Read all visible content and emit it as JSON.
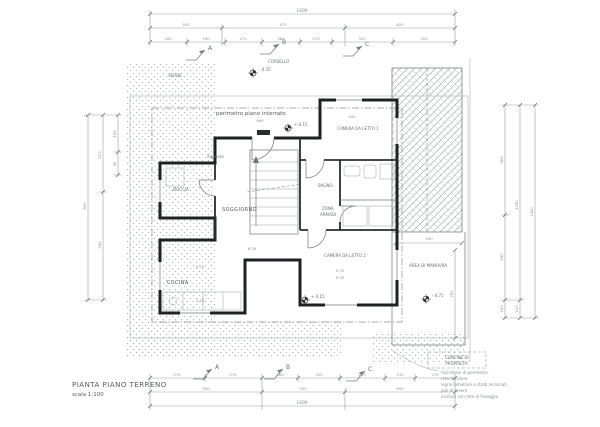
{
  "title_block": {
    "title": "PIANTA PIANO TERRENO",
    "scale": "scala 1:100"
  },
  "labels": {
    "perimeter": "perimetro piano interrato",
    "verde": "VERDE",
    "corsello": "CORSELLO",
    "ingresso": "ingresso",
    "soggiorno": "SOGGIORNO",
    "doccia": "DOCCIA",
    "cucina": "CUCINA",
    "camera1": "CAMERA DA LETTO 1",
    "bagno": "BAGNO",
    "armadi_1": "ZONA",
    "armadi_2": "ARMADI",
    "camera2": "CAMERA DA LETTO 2",
    "area_manovra": "AREA DI MANOVRA",
    "confine_1": "CONFINE DI",
    "confine_2": "PROPRIETA'"
  },
  "sections": {
    "a": "A",
    "b": "B",
    "c": "C"
  },
  "elevations": {
    "corsello": "- 0.35",
    "ingresso": "+ 0.15",
    "camera2": "+ 0.15",
    "manovra": "- 0.75"
  },
  "note": {
    "line1": "recinzione di perimetro:",
    "line2": "rete di colore",
    "line3": "legno lamellare a strati incrociati",
    "line4": "pali di rovere",
    "line5": "incrocci con rete di fissaggio"
  },
  "dims": {
    "top_total": "1600",
    "top_mid": [
      "500",
      "475",
      "620"
    ],
    "top_fine": [
      "185",
      "190",
      "170",
      "380",
      "170",
      "310",
      "310"
    ],
    "bottom_fine": [
      "275",
      "275",
      "180",
      "205",
      "235",
      "140",
      "275"
    ],
    "bottom_mid": [
      "550",
      "400",
      "650"
    ],
    "bottom_total": "1600",
    "left_outer": "800",
    "left_mid": [
      "370",
      "595"
    ],
    "left_fine": [
      "165",
      "80"
    ],
    "right_inner": [
      "565",
      "690",
      "160"
    ],
    "right_mid": [
      "1250",
      "110"
    ],
    "right_outer": "1400",
    "manovra_w": "540",
    "manovra_h": "760",
    "interior": {
      "top_a": "965",
      "top_b": "940",
      "cucina_w": "4.70",
      "cucina_h": "3.16",
      "soggiorno": "6.78",
      "camera2_w": "5.70",
      "camera2_w2": "5.05"
    }
  }
}
